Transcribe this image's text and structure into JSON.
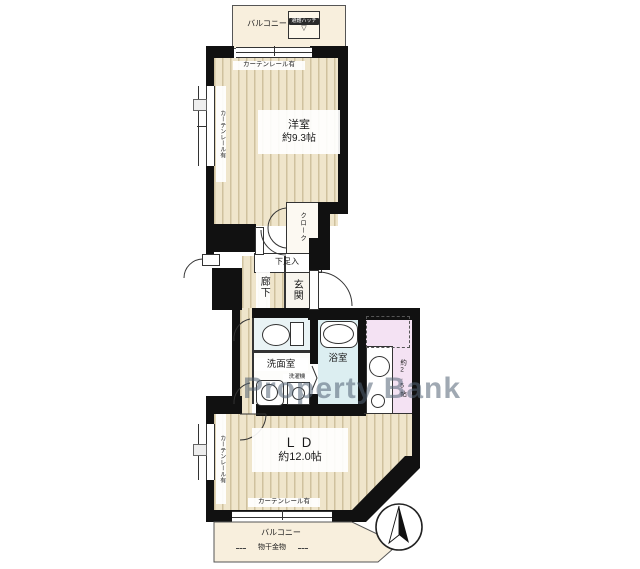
{
  "watermark": "Property Bank",
  "balconies": {
    "top_label": "バルコニー",
    "bottom_label": "バルコニー",
    "hatch_label": "避難ハッチ",
    "laundry_pole_label": "物干金物"
  },
  "rooms": {
    "western": {
      "name": "洋室",
      "size": "約9.3帖"
    },
    "living_dining": {
      "name": "ＬＤ",
      "size": "約12.0帖"
    },
    "kitchen": {
      "size": "約2.5帖"
    },
    "hallway": "廊下",
    "entrance": "玄関",
    "washroom": "洗面室",
    "bathroom": "浴室",
    "closet": "クローク",
    "shoe_cabinet": "下足入",
    "washing_machine": "洗濯機"
  },
  "annotations": {
    "curtain_rail": "カーテンレール有"
  },
  "colors": {
    "wall": "#111111",
    "floor_base": "#efe5cb",
    "floor_stripe": "#cfc19e",
    "balcony": "#f8efdd",
    "bathroom_floor": "#dceef1",
    "toilet_floor": "#e9f3f5",
    "kitchen_floor": "#f4e2f3",
    "watermark_color": "#52627444"
  }
}
